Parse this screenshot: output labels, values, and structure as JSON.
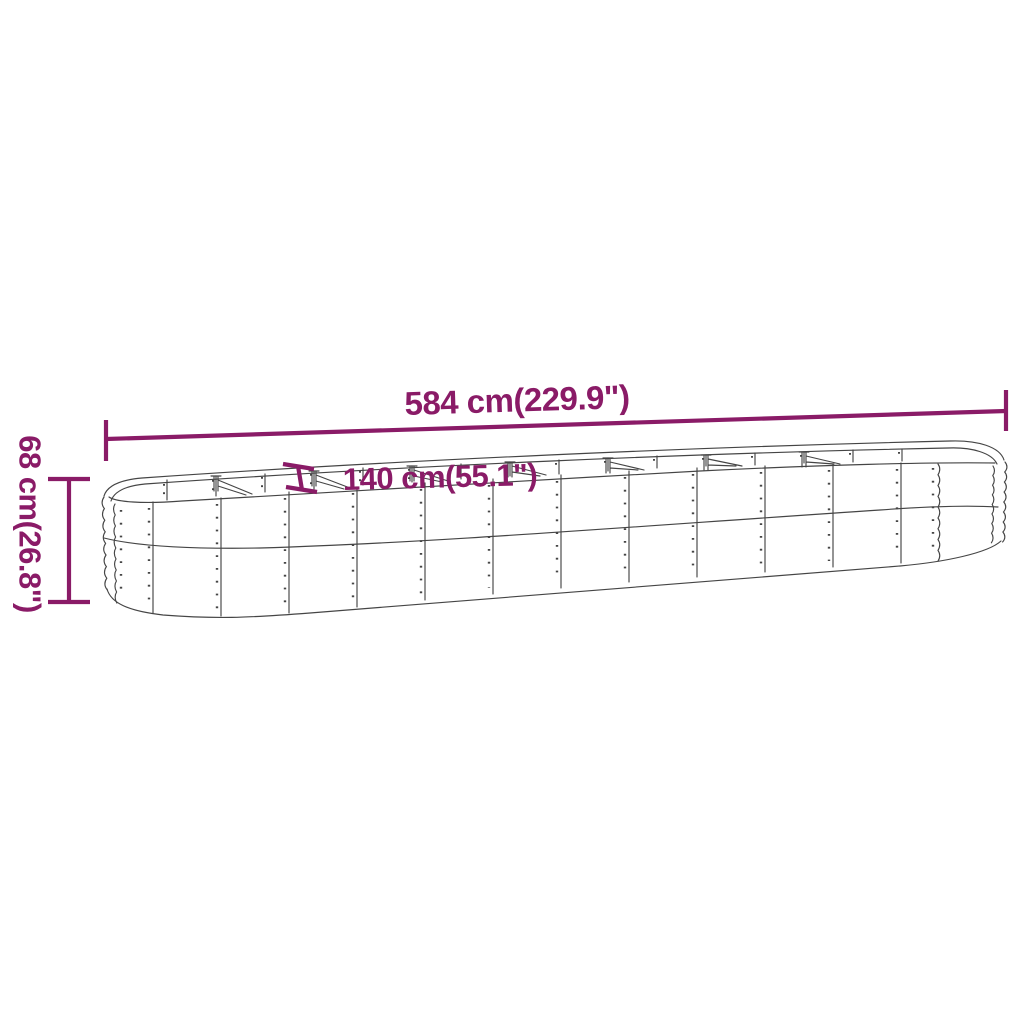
{
  "diagram": {
    "kind": "product-dimension-drawing",
    "subject": "oval-raised-garden-bed",
    "dimensions": {
      "length": {
        "label": "584 cm(229.9\")",
        "value_cm": "584",
        "value_inch": "229.9"
      },
      "width": {
        "label": "140 cm(55.1\")",
        "value_cm": "140",
        "value_inch": "55.1"
      },
      "height": {
        "label": "68 cm(26.8\")",
        "value_cm": "68",
        "value_inch": "26.8"
      }
    },
    "colors": {
      "dimension_accent": "#8A1B67",
      "line_art": "#454545",
      "background": "#FFFFFF"
    }
  }
}
